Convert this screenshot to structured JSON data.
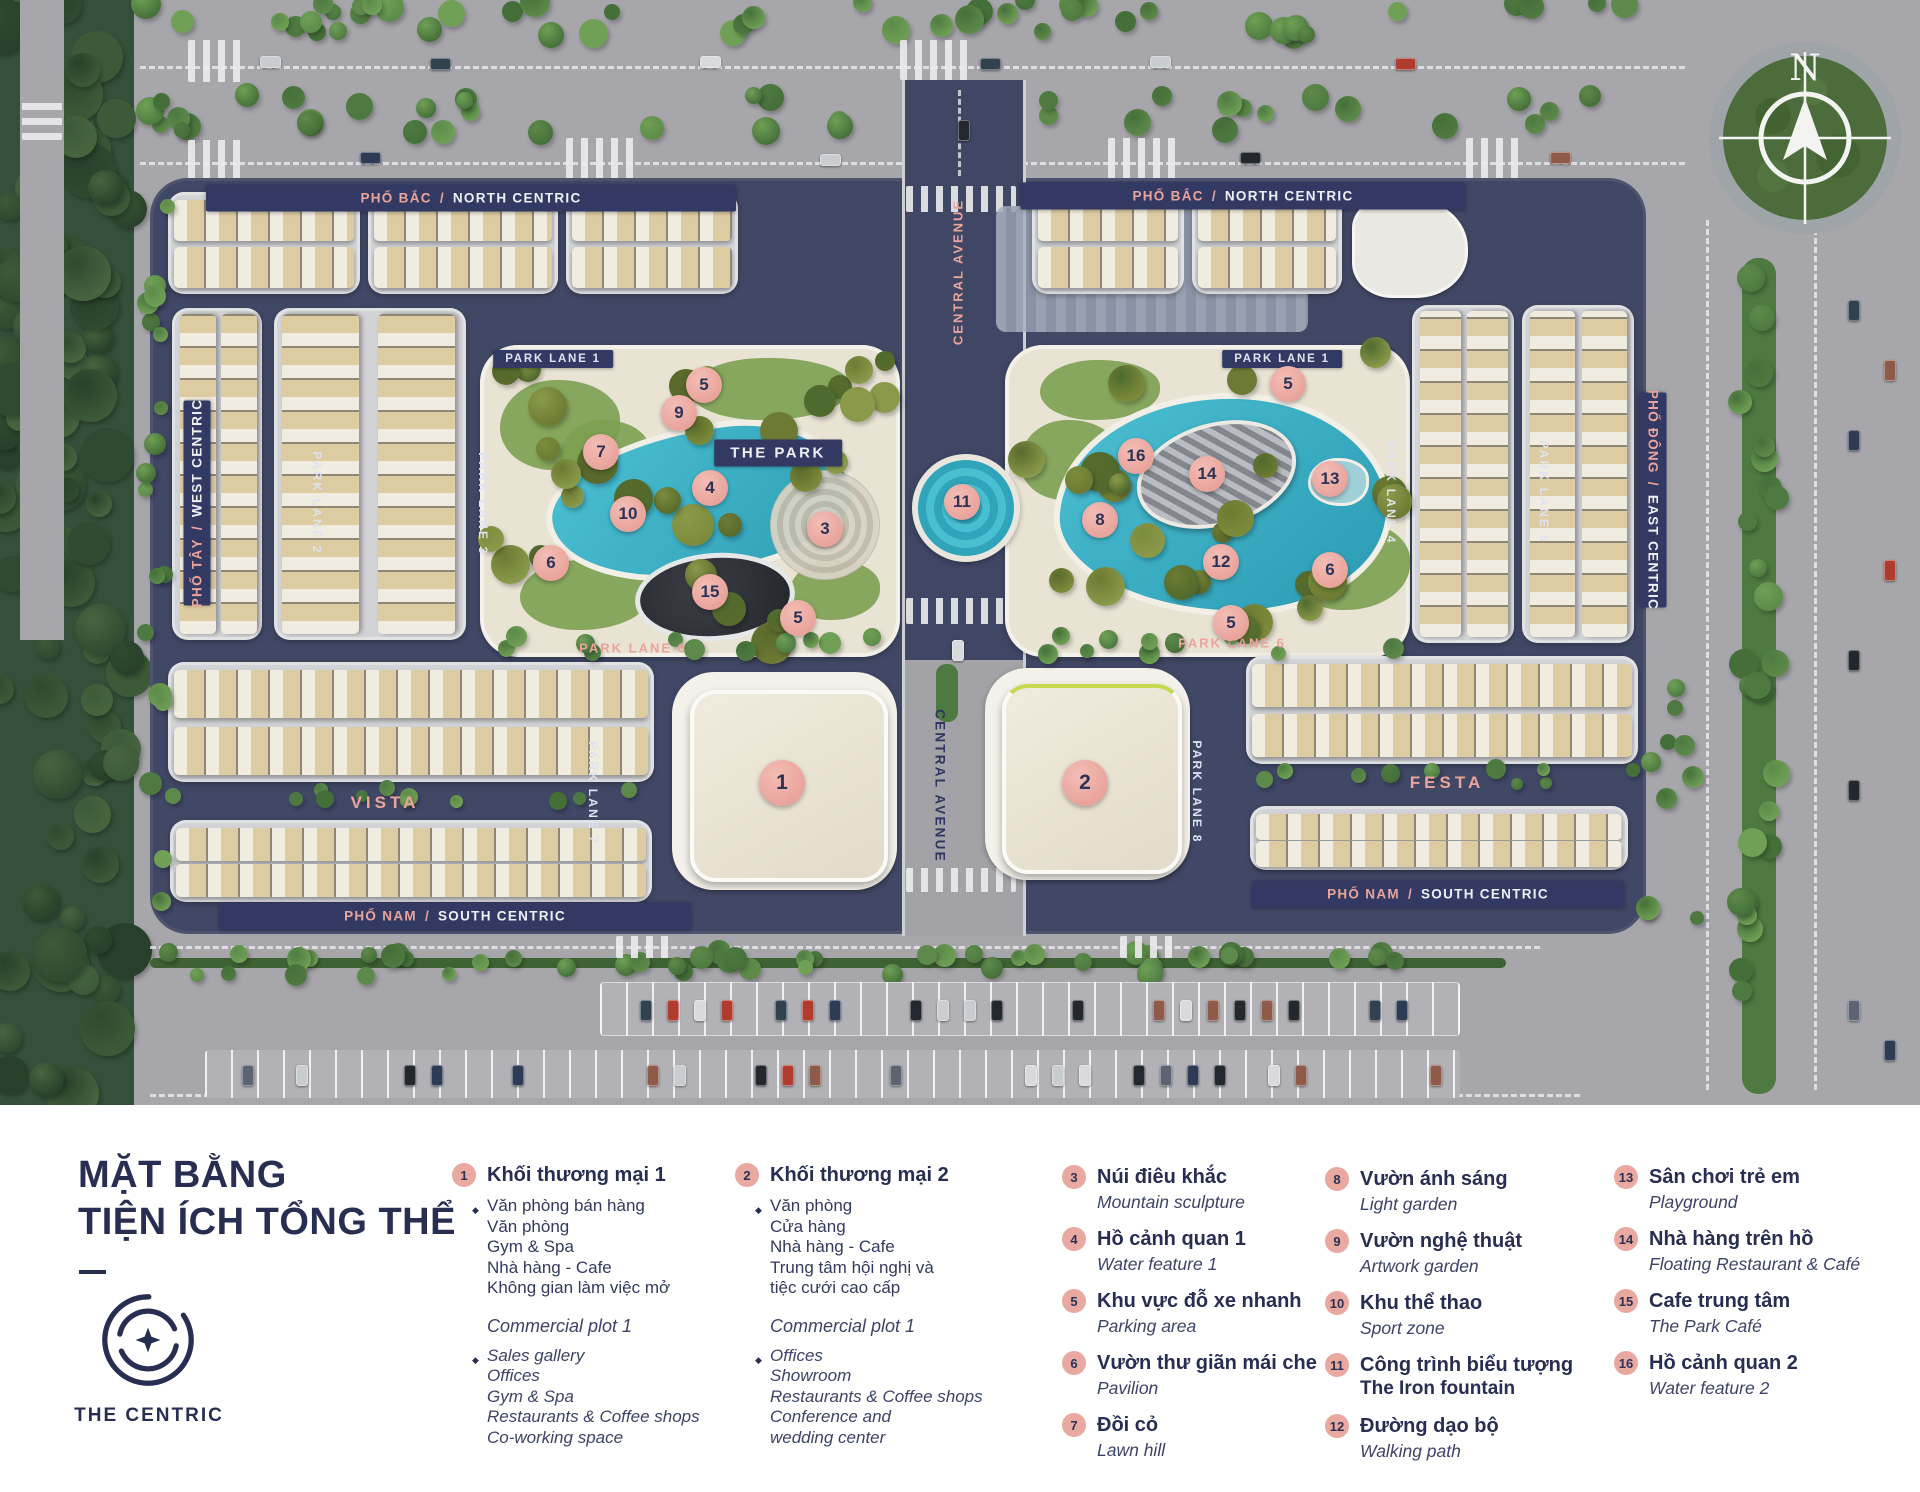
{
  "map": {
    "compass_letter": "N",
    "street_banners": [
      {
        "vi": "PHỐ BẮC",
        "en": "NORTH CENTRIC",
        "x": 471,
        "y": 198,
        "w": 530,
        "o": "h"
      },
      {
        "vi": "PHỐ BẮC",
        "en": "NORTH CENTRIC",
        "x": 1243,
        "y": 196,
        "w": 445,
        "o": "h"
      },
      {
        "vi": "PHỐ NAM",
        "en": "SOUTH CENTRIC",
        "x": 455,
        "y": 916,
        "w": 472,
        "o": "h"
      },
      {
        "vi": "PHỐ NAM",
        "en": "SOUTH CENTRIC",
        "x": 1438,
        "y": 894,
        "w": 372,
        "o": "h"
      },
      {
        "vi": "PHỐ TÂY",
        "en": "WEST CENTRIC",
        "x": 197,
        "y": 503,
        "w": 205,
        "o": "vu"
      },
      {
        "vi": "PHỐ ĐÔNG",
        "en": "EAST CENTRIC",
        "x": 1653,
        "y": 500,
        "w": 215,
        "o": "vd"
      }
    ],
    "road_labels": [
      {
        "t": "PARK LANE 1",
        "x": 553,
        "y": 359,
        "s": "chip",
        "o": "h"
      },
      {
        "t": "PARK LANE 1",
        "x": 1282,
        "y": 359,
        "s": "chip",
        "o": "h"
      },
      {
        "t": "THE PARK",
        "x": 778,
        "y": 453,
        "s": "chip-lg",
        "o": "h"
      },
      {
        "t": "PARK LANE 2",
        "x": 317,
        "y": 503,
        "s": "lane",
        "o": "vd"
      },
      {
        "t": "PARK LANE 3",
        "x": 483,
        "y": 504,
        "s": "lane",
        "o": "vd"
      },
      {
        "t": "PARK LANE 4",
        "x": 1391,
        "y": 493,
        "s": "lane",
        "o": "vd"
      },
      {
        "t": "PARK LANE 5",
        "x": 1544,
        "y": 492,
        "s": "lane",
        "o": "vd"
      },
      {
        "t": "PARK LANE 7",
        "x": 593,
        "y": 793,
        "s": "lane",
        "o": "vd"
      },
      {
        "t": "PARK LANE 8",
        "x": 1197,
        "y": 792,
        "s": "lane",
        "o": "vd"
      },
      {
        "t": "PARK LANE 6",
        "x": 633,
        "y": 648,
        "s": "pink",
        "o": "h"
      },
      {
        "t": "PARK LANE 6",
        "x": 1232,
        "y": 643,
        "s": "pink",
        "o": "h"
      },
      {
        "t": "CENTRAL AVENUE",
        "x": 958,
        "y": 272,
        "s": "pink",
        "o": "vu"
      },
      {
        "t": "CENTRAL AVENUE",
        "x": 940,
        "y": 786,
        "s": "navy",
        "o": "vd"
      },
      {
        "t": "VISTA",
        "x": 385,
        "y": 803,
        "s": "pink-lg",
        "o": "h"
      },
      {
        "t": "FESTA",
        "x": 1447,
        "y": 783,
        "s": "pink-lg",
        "o": "h"
      }
    ],
    "markers": [
      {
        "n": "5",
        "x": 704,
        "y": 385
      },
      {
        "n": "9",
        "x": 679,
        "y": 413
      },
      {
        "n": "7",
        "x": 601,
        "y": 452
      },
      {
        "n": "4",
        "x": 710,
        "y": 488
      },
      {
        "n": "10",
        "x": 628,
        "y": 514
      },
      {
        "n": "3",
        "x": 825,
        "y": 529
      },
      {
        "n": "6",
        "x": 551,
        "y": 563
      },
      {
        "n": "15",
        "x": 710,
        "y": 592
      },
      {
        "n": "5",
        "x": 798,
        "y": 618
      },
      {
        "n": "11",
        "x": 962,
        "y": 502
      },
      {
        "n": "5",
        "x": 1288,
        "y": 384
      },
      {
        "n": "16",
        "x": 1136,
        "y": 456
      },
      {
        "n": "14",
        "x": 1207,
        "y": 474
      },
      {
        "n": "13",
        "x": 1330,
        "y": 479
      },
      {
        "n": "8",
        "x": 1100,
        "y": 520
      },
      {
        "n": "12",
        "x": 1221,
        "y": 562
      },
      {
        "n": "6",
        "x": 1330,
        "y": 570
      },
      {
        "n": "5",
        "x": 1231,
        "y": 623
      },
      {
        "n": "1",
        "x": 782,
        "y": 783,
        "big": true
      },
      {
        "n": "2",
        "x": 1085,
        "y": 783,
        "big": true
      }
    ]
  },
  "legend": {
    "title_line1": "MẶT BẰNG",
    "title_line2": "TIỆN ÍCH TỔNG THỂ",
    "brand": "THE CENTRIC",
    "groups": [
      {
        "num": "1",
        "title": "Khối thương mại 1",
        "vi_items": [
          "Văn phòng bán hàng",
          "Văn phòng",
          "Gym & Spa",
          "Nhà hàng - Cafe",
          "Không gian làm việc mở"
        ],
        "en_title": "Commercial plot 1",
        "en_items": [
          "Sales gallery",
          "Offices",
          "Gym & Spa",
          "Restaurants & Coffee shops",
          "Co-working space"
        ]
      },
      {
        "num": "2",
        "title": "Khối thương mại 2",
        "vi_items": [
          "Văn phòng",
          "Cửa hàng",
          "Nhà hàng - Cafe",
          "Trung tâm hội nghị và",
          "tiệc cưới cao cấp"
        ],
        "en_title": "Commercial plot 1",
        "en_items": [
          "Offices",
          "Showroom",
          "Restaurants & Coffee shops",
          "Conference and",
          "wedding center"
        ]
      }
    ],
    "items": [
      {
        "num": "3",
        "title": "Núi điêu khắc",
        "en": "Mountain sculpture",
        "col": 3
      },
      {
        "num": "4",
        "title": "Hồ cảnh quan 1",
        "en": "Water feature 1",
        "col": 3
      },
      {
        "num": "5",
        "title": "Khu vực đỗ xe nhanh",
        "en": "Parking area",
        "col": 3
      },
      {
        "num": "6",
        "title": "Vườn thư giãn mái che",
        "en": "Pavilion",
        "col": 3
      },
      {
        "num": "7",
        "title": "Đồi cỏ",
        "en": "Lawn hill",
        "col": 3
      },
      {
        "num": "8",
        "title": "Vườn ánh sáng",
        "en": "Light garden",
        "col": 4
      },
      {
        "num": "9",
        "title": "Vườn nghệ thuật",
        "en": "Artwork garden",
        "col": 4
      },
      {
        "num": "10",
        "title": "Khu thể thao",
        "en": "Sport zone",
        "col": 4
      },
      {
        "num": "11",
        "title": "Công trình biểu tượng",
        "en": "The Iron fountain",
        "en_bold": true,
        "col": 4
      },
      {
        "num": "12",
        "title": "Đường dạo bộ",
        "en": "Walking path",
        "col": 4
      },
      {
        "num": "13",
        "title": "Sân chơi trẻ em",
        "en": "Playground",
        "col": 5
      },
      {
        "num": "14",
        "title": "Nhà hàng trên hồ",
        "en": "Floating Restaurant & Café",
        "col": 5
      },
      {
        "num": "15",
        "title": "Cafe trung tâm",
        "en": "The Park Café",
        "col": 5
      },
      {
        "num": "16",
        "title": "Hồ cảnh quan 2",
        "en": "Water feature 2",
        "col": 5
      }
    ]
  },
  "colors": {
    "navy": "#2c3357",
    "salmon": "#e9a198",
    "marker_fill": "#ecaca4",
    "banner_navy": "#323963",
    "teal": "#3fb5c9"
  }
}
